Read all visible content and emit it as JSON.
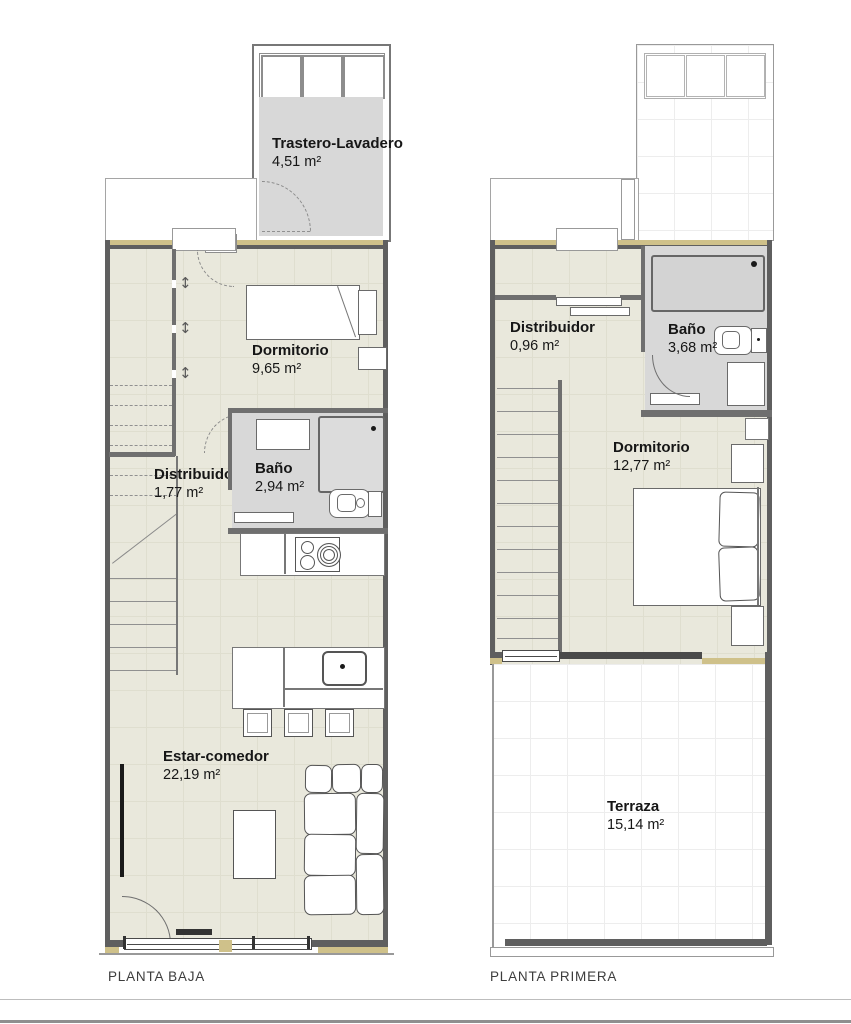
{
  "colors": {
    "wall": "#5f5f5f",
    "partition": "#6f6f6f",
    "tan": "#cfc18a",
    "floor": "#e9e8dc",
    "wet": "#d8d8d8",
    "ink": "#161616",
    "line": "#8d8d8d"
  },
  "icons": {
    "updown": "↕"
  },
  "plans": [
    {
      "title": "PLANTA BAJA",
      "rooms": [
        {
          "name": "Trastero-Lavadero",
          "area": "4,51 m²"
        },
        {
          "name": "Dormitorio",
          "area": "9,65 m²"
        },
        {
          "name": "Distribuidor",
          "area": "1,77 m²"
        },
        {
          "name": "Baño",
          "area": "2,94 m²"
        },
        {
          "name": "Estar-comedor",
          "area": "22,19 m²"
        }
      ]
    },
    {
      "title": "PLANTA PRIMERA",
      "rooms": [
        {
          "name": "Distribuidor",
          "area": "0,96 m²"
        },
        {
          "name": "Baño",
          "area": "3,68 m²"
        },
        {
          "name": "Dormitorio",
          "area": "12,77 m²"
        },
        {
          "name": "Terraza",
          "area": "15,14 m²"
        }
      ]
    }
  ]
}
